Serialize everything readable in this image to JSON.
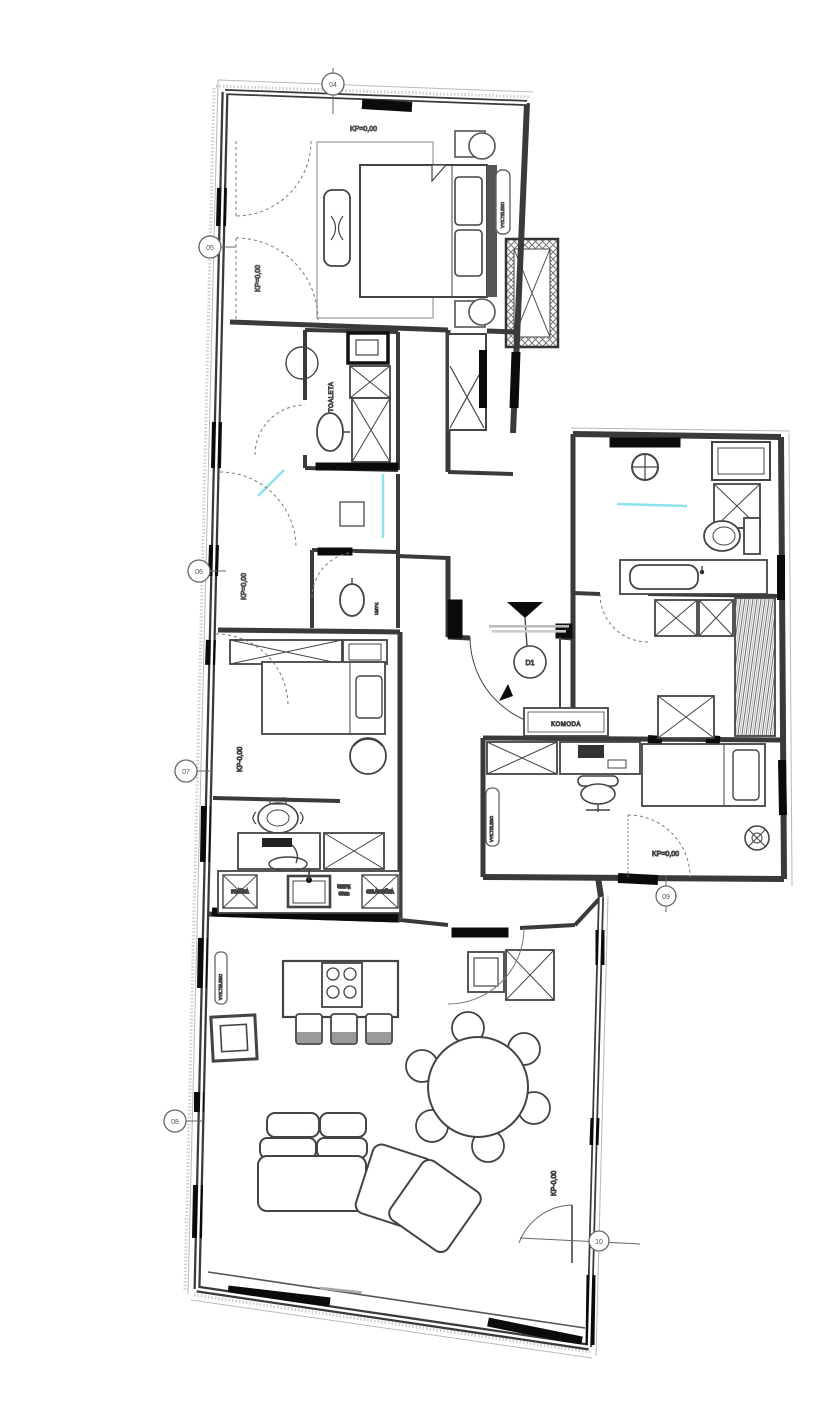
{
  "drawing": {
    "kind": "apartment floor plan",
    "levels": {
      "bedroom_top": "KP=0,00",
      "bedroom_left": "KP=0,00",
      "hall": "KP=0,00",
      "bedroom2": "KP-0,00",
      "room_komoda": "KP=0,00",
      "living": "KP-0,00"
    },
    "rooms": {
      "toilet": "TOALETA"
    },
    "furniture": {
      "komoda": "KOMODA"
    },
    "fixtures": {
      "wc_sink": "UMYV.",
      "washer": "PRÁČKA",
      "dishwasher_line1": "UMYV.",
      "dishwasher_line2": "60cm",
      "fridge": "CHLADNIČKA",
      "radiator": "VYK.TELESO"
    },
    "entrance": {
      "door_code": "D1"
    },
    "grid_markers": {
      "top": "04",
      "left1": "05",
      "left2": "06",
      "left3": "07",
      "left4": "08",
      "right": "09",
      "bottom_right": "10"
    },
    "colors": {
      "wall": "#333333",
      "accent": "#8ce1ec",
      "paper": "#ffffff"
    }
  }
}
